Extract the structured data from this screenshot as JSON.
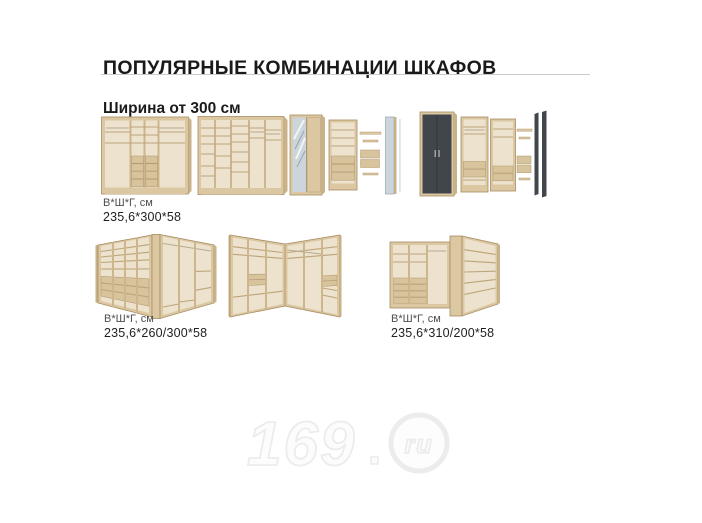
{
  "header": {
    "title": "ПОПУЛЯРНЫЕ КОМБИНАЦИИ ШКАФОВ",
    "subtitle": "Ширина от 300 см"
  },
  "captions": {
    "row1": {
      "label": "В*Ш*Г, см",
      "value": "235,6*300*58"
    },
    "row2_left": {
      "label": "В*Ш*Г, см",
      "value": "235,6*260/300*58"
    },
    "row2_right": {
      "label": "В*Ш*Г, см",
      "value": "235,6*310/200*58"
    }
  },
  "watermark": {
    "number": "169",
    "suffix": "ru"
  },
  "colors": {
    "background": "#ffffff",
    "title_text": "#1a1a1a",
    "divider": "#cbcbcb",
    "caption_label": "#4f4f4f",
    "caption_value": "#1f1f1f",
    "wood_light": "#dbc7a2",
    "wood_side": "#c9b188",
    "wood_edge": "#a88d62",
    "interior": "#ece2cd",
    "drawer": "#d7c39c",
    "dark_door": "#41454c",
    "mirror": "#ccd5d9",
    "watermark": "#ececec"
  }
}
